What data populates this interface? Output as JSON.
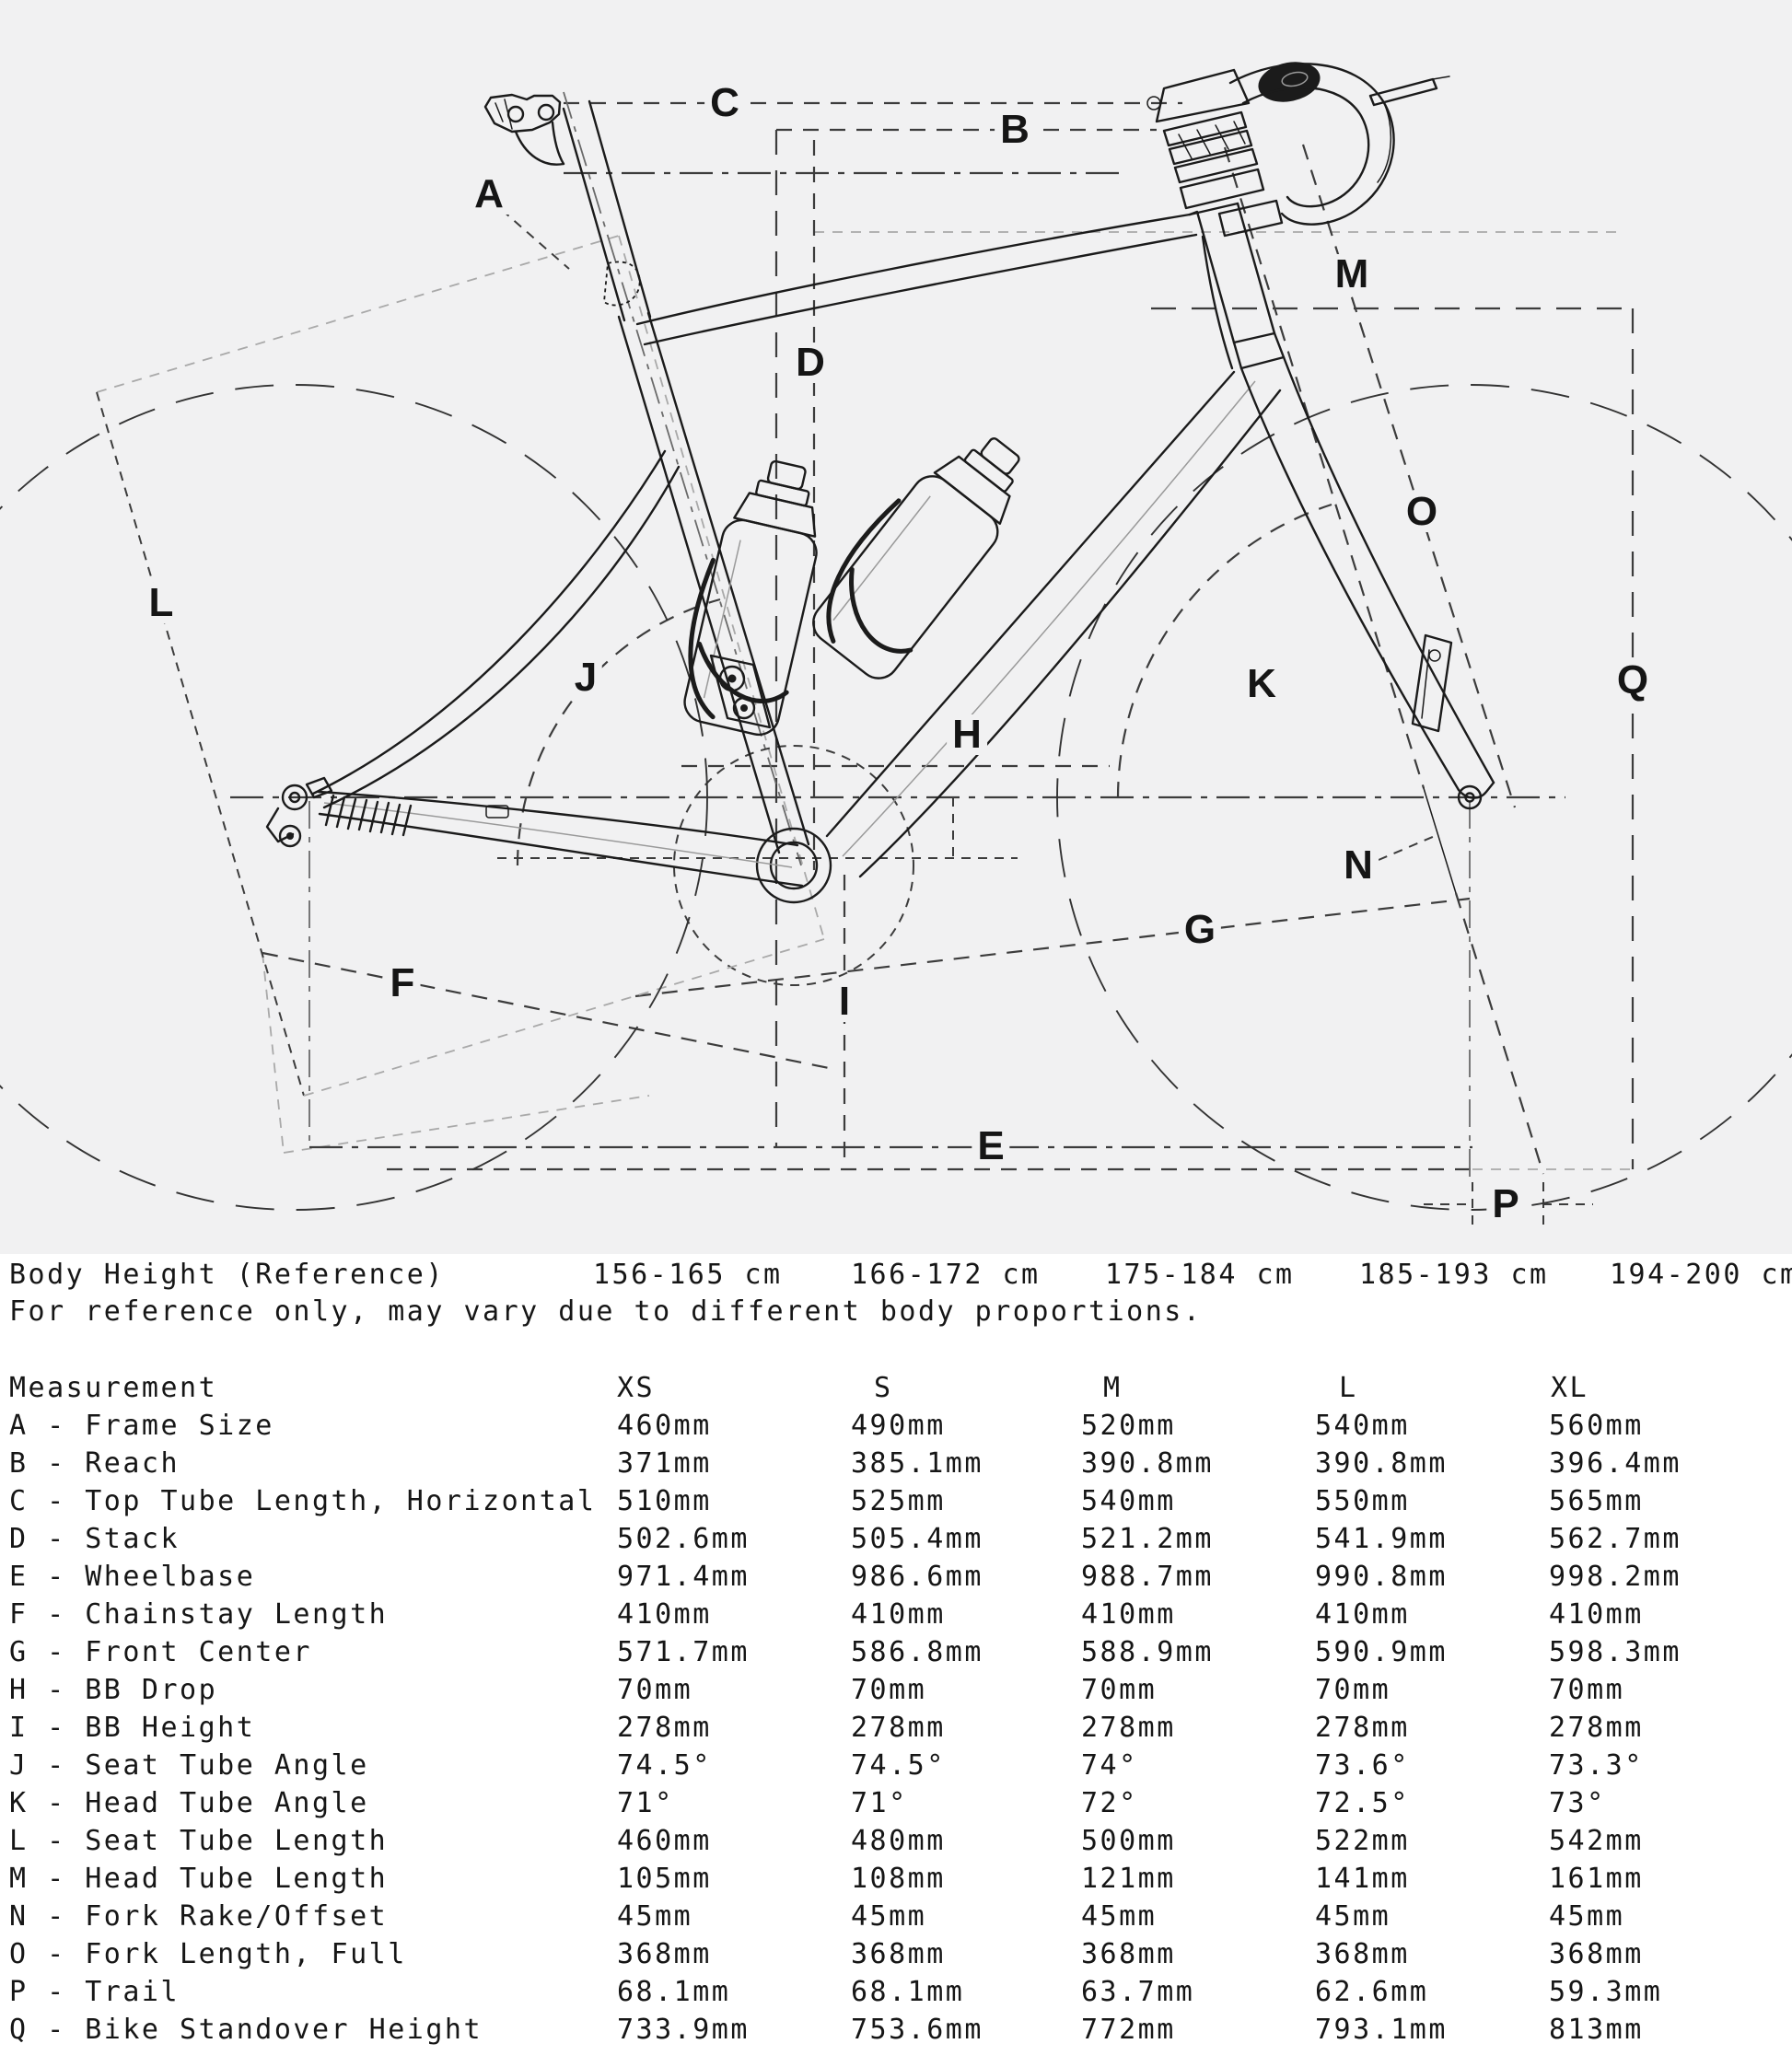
{
  "diagram": {
    "background": "#f1f1f2",
    "ink_color": "#1b1b1b",
    "dim_color": "#3c3c3c",
    "light_dim_color": "#a9a9a9",
    "labels": [
      "A",
      "B",
      "C",
      "D",
      "E",
      "F",
      "G",
      "H",
      "I",
      "J",
      "K",
      "L",
      "M",
      "N",
      "O",
      "P",
      "Q"
    ]
  },
  "body_height": {
    "label": "Body Height (Reference)",
    "values": [
      "156-165 cm",
      "166-172 cm",
      "175-184 cm",
      "185-193 cm",
      "194-200 cm"
    ],
    "note": "For reference only, may vary due to different body proportions."
  },
  "table": {
    "measurement_header": "Measurement",
    "size_headers": [
      "XS",
      "S",
      "M",
      "L",
      "XL"
    ],
    "rows": [
      {
        "label": "A - Frame Size",
        "values": [
          "460mm",
          "490mm",
          "520mm",
          "540mm",
          "560mm"
        ]
      },
      {
        "label": "B - Reach",
        "values": [
          "371mm",
          "385.1mm",
          "390.8mm",
          "390.8mm",
          "396.4mm"
        ]
      },
      {
        "label": "C - Top Tube Length, Horizontal",
        "values": [
          "510mm",
          "525mm",
          "540mm",
          "550mm",
          "565mm"
        ]
      },
      {
        "label": "D - Stack",
        "values": [
          "502.6mm",
          "505.4mm",
          "521.2mm",
          "541.9mm",
          "562.7mm"
        ]
      },
      {
        "label": "E - Wheelbase",
        "values": [
          "971.4mm",
          "986.6mm",
          "988.7mm",
          "990.8mm",
          "998.2mm"
        ]
      },
      {
        "label": "F - Chainstay Length",
        "values": [
          "410mm",
          "410mm",
          "410mm",
          "410mm",
          "410mm"
        ]
      },
      {
        "label": "G - Front Center",
        "values": [
          "571.7mm",
          "586.8mm",
          "588.9mm",
          "590.9mm",
          "598.3mm"
        ]
      },
      {
        "label": "H - BB Drop",
        "values": [
          "70mm",
          "70mm",
          "70mm",
          "70mm",
          "70mm"
        ]
      },
      {
        "label": "I - BB Height",
        "values": [
          "278mm",
          "278mm",
          "278mm",
          "278mm",
          "278mm"
        ]
      },
      {
        "label": "J - Seat Tube Angle",
        "values": [
          "74.5°",
          "74.5°",
          "74°",
          "73.6°",
          "73.3°"
        ]
      },
      {
        "label": "K - Head Tube Angle",
        "values": [
          "71°",
          "71°",
          "72°",
          "72.5°",
          "73°"
        ]
      },
      {
        "label": "L - Seat Tube Length",
        "values": [
          "460mm",
          "480mm",
          "500mm",
          "522mm",
          "542mm"
        ]
      },
      {
        "label": "M - Head Tube Length",
        "values": [
          "105mm",
          "108mm",
          "121mm",
          "141mm",
          "161mm"
        ]
      },
      {
        "label": "N - Fork Rake/Offset",
        "values": [
          "45mm",
          "45mm",
          "45mm",
          "45mm",
          "45mm"
        ]
      },
      {
        "label": "O - Fork Length, Full",
        "values": [
          "368mm",
          "368mm",
          "368mm",
          "368mm",
          "368mm"
        ]
      },
      {
        "label": "P - Trail",
        "values": [
          "68.1mm",
          "68.1mm",
          "63.7mm",
          "62.6mm",
          "59.3mm"
        ]
      },
      {
        "label": "Q - Bike Standover Height",
        "values": [
          "733.9mm",
          "753.6mm",
          "772mm",
          "793.1mm",
          "813mm"
        ]
      }
    ]
  }
}
